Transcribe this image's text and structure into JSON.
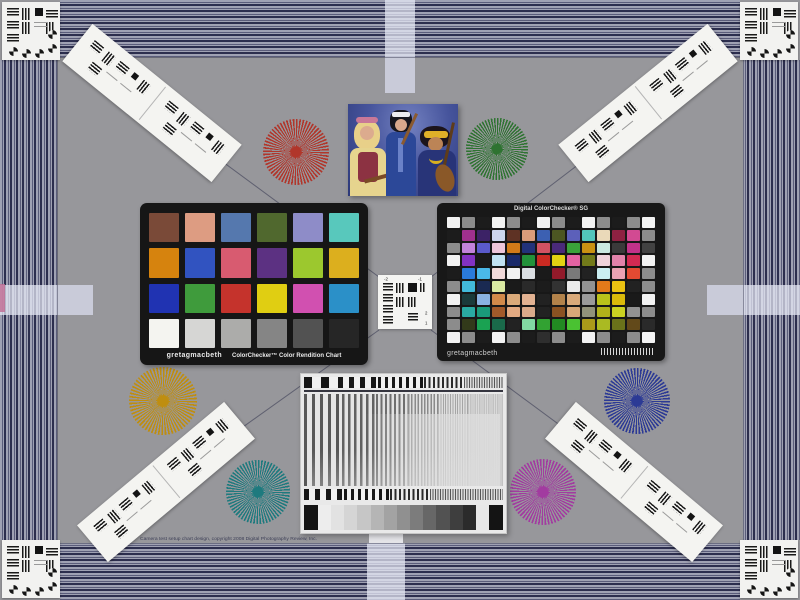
{
  "scene": {
    "background": "#97979b",
    "caption": "Camera test setup chart design, copyright 2008 Digital Photography Review, Inc."
  },
  "border": {
    "stripe_light": "#9fa1b3",
    "stripe_dark": "#2c2e4e",
    "tab_light": "#e8eaf6",
    "edge_mark_magenta": "#c06a92"
  },
  "classic": {
    "brand": "gretagmacbeth",
    "title": "ColorChecker™ Color Rendition Chart",
    "patches": [
      "#7a4a38",
      "#dd9c82",
      "#5578ae",
      "#50682e",
      "#8e8cc8",
      "#58c8bc",
      "#d6830e",
      "#3153c0",
      "#d85b70",
      "#5c3182",
      "#9cc82e",
      "#dcaf1e",
      "#2033b2",
      "#3f9b3c",
      "#c5332c",
      "#e0ce12",
      "#d150b0",
      "#2b90c8",
      "#f4f4f0",
      "#d6d6d4",
      "#acacaa",
      "#858585",
      "#525252",
      "#262626"
    ]
  },
  "sg": {
    "title": "Digital ColorChecker® SG",
    "brand": "gretagmacbeth",
    "cols": 14,
    "rows": 10,
    "patches": [
      "#f2f2f2",
      "#8c8c8c",
      "#1c1c1c",
      "#f2f2f2",
      "#8c8c8c",
      "#1c1c1c",
      "#f2f2f2",
      "#8c8c8c",
      "#1c1c1c",
      "#f2f2f2",
      "#8c8c8c",
      "#1c1c1c",
      "#8c8c8c",
      "#f2f2f2",
      "#1c1c1c",
      "#a0308e",
      "#3c2266",
      "#ccd6ec",
      "#5e3224",
      "#da9c7a",
      "#3c60b2",
      "#4c5622",
      "#5c60ba",
      "#52c6ba",
      "#ead9b9",
      "#8e2142",
      "#d24a92",
      "#8c8c8c",
      "#8c8c8c",
      "#c282da",
      "#5a5aca",
      "#eec6da",
      "#d27a18",
      "#22327a",
      "#d25262",
      "#4a2a7a",
      "#3aa23a",
      "#ca9212",
      "#cae9e1",
      "#3a3a3a",
      "#c23289",
      "#424242",
      "#f2f2f2",
      "#8232c2",
      "#1a1a1a",
      "#c2e2f2",
      "#1a2a6a",
      "#22923a",
      "#ca2a22",
      "#e2d212",
      "#e262a2",
      "#727a1a",
      "#eed2da",
      "#e282aa",
      "#d22a52",
      "#f2f2f2",
      "#1c1c1c",
      "#2a7ada",
      "#4ab8e8",
      "#f2dada",
      "#f2f2f2",
      "#dadee2",
      "#1a1a1a",
      "#921a2a",
      "#7a7a7a",
      "#222222",
      "#caeef2",
      "#eaa2b2",
      "#e24a32",
      "#8c8c8c",
      "#8c8c8c",
      "#42bada",
      "#1a2a52",
      "#daeaa2",
      "#1a1a1a",
      "#2a2a2a",
      "#1c1c1c",
      "#323232",
      "#eaeaea",
      "#929292",
      "#e27a1a",
      "#eac212",
      "#222222",
      "#8c8c8c",
      "#f2f2f2",
      "#1a3a3a",
      "#8ab2e2",
      "#d28a4a",
      "#daaa7a",
      "#e2b292",
      "#222222",
      "#b2824a",
      "#daaa7a",
      "#9a9a9a",
      "#bac21a",
      "#daba0a",
      "#1a1a1a",
      "#f2f2f2",
      "#8c8c8c",
      "#2aaaa2",
      "#1a9a7a",
      "#a25a2a",
      "#e2aa82",
      "#daaa8a",
      "#222222",
      "#8a5222",
      "#d8a878",
      "#92927a",
      "#b2b21a",
      "#cad222",
      "#929292",
      "#8c8c8c",
      "#8c8c8c",
      "#323a1a",
      "#1aa252",
      "#1a6a4a",
      "#222222",
      "#82daa2",
      "#32a232",
      "#228a22",
      "#4ac232",
      "#aa9a1a",
      "#aaba22",
      "#6a721a",
      "#62491a",
      "#2a2a2a",
      "#f2f2f2",
      "#8c8c8c",
      "#1c1c1c",
      "#f2f2f2",
      "#8c8c8c",
      "#1c1c1c",
      "#2e2e2e",
      "#8c8c8c",
      "#1c1c1c",
      "#f2f2f2",
      "#8c8c8c",
      "#1c1c1c",
      "#8c8c8c",
      "#f2f2f2"
    ]
  },
  "center_target": {
    "top_left": "-2",
    "top_right": "-1",
    "right_top": "2",
    "right_bottom": "1"
  },
  "stars": [
    {
      "name": "red-star",
      "color": "#b1362b"
    },
    {
      "name": "green-star",
      "color": "#2e7331"
    },
    {
      "name": "gold-star",
      "color": "#bf8e10"
    },
    {
      "name": "teal-star",
      "color": "#1e7a7e"
    },
    {
      "name": "magenta-star",
      "color": "#a23ba0"
    },
    {
      "name": "navy-star",
      "color": "#2c3a95"
    }
  ],
  "grayscale_wedge": [
    "#141414",
    "#ededed",
    "#e2e2e2",
    "#d5d5d5",
    "#c6c6c6",
    "#b5b5b5",
    "#a3a3a3",
    "#909090",
    "#7c7c7c",
    "#676767",
    "#525252",
    "#3e3e3e",
    "#2b2b2b",
    "#e8e8e8",
    "#141414"
  ]
}
